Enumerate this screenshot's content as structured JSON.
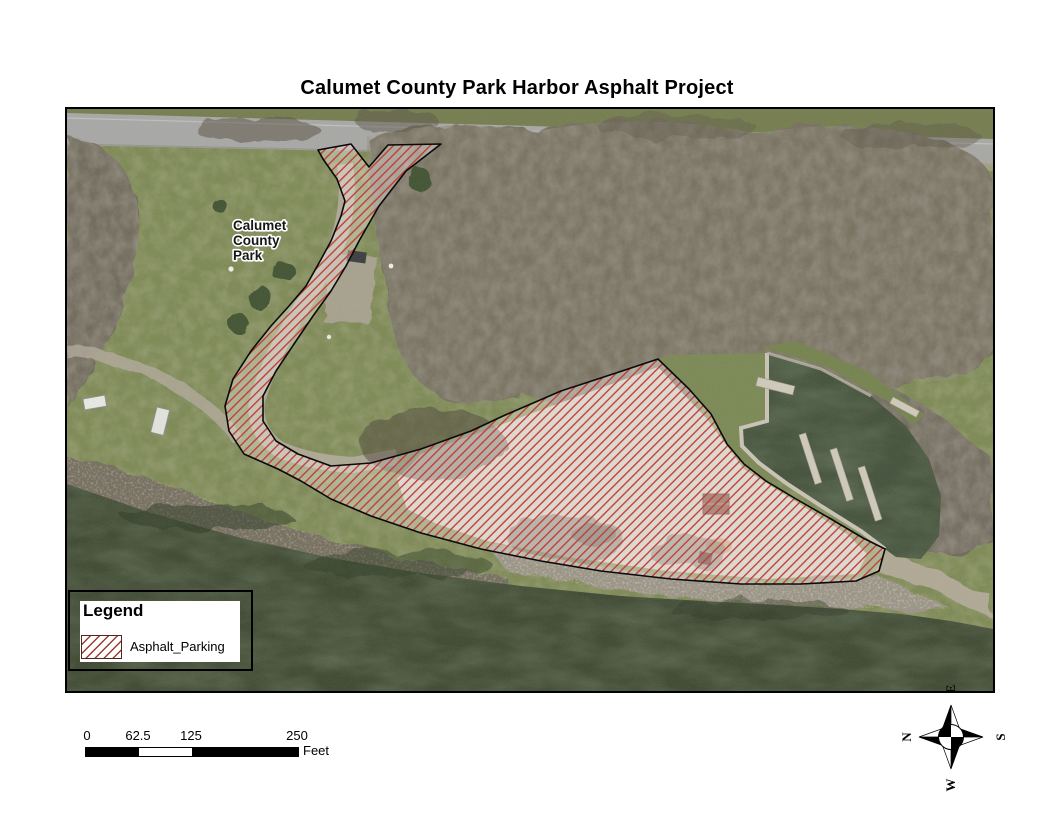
{
  "page": {
    "title": "Calumet County Park Harbor Asphalt Project"
  },
  "map_label": {
    "line1": "Calumet",
    "line2": "County",
    "line3": "Park"
  },
  "legend": {
    "title": "Legend",
    "items": [
      {
        "label": "Asphalt_Parking",
        "swatch": "red-diagonal-hatch"
      }
    ]
  },
  "scale_bar": {
    "tick0": "0",
    "tick1": "62.5",
    "tick2": "125",
    "tick3": "250",
    "unit": "Feet"
  },
  "north_arrow": {
    "n": "N",
    "e": "E",
    "s": "S",
    "w": "W"
  },
  "colors": {
    "hatch_red": "#c23b33",
    "polygon_outline": "#0a0a0a",
    "water_green": "#3d4831",
    "grass_green": "#7d8955",
    "road_gray": "#a8a8a6",
    "gravel_tan": "#ccc6ba"
  }
}
